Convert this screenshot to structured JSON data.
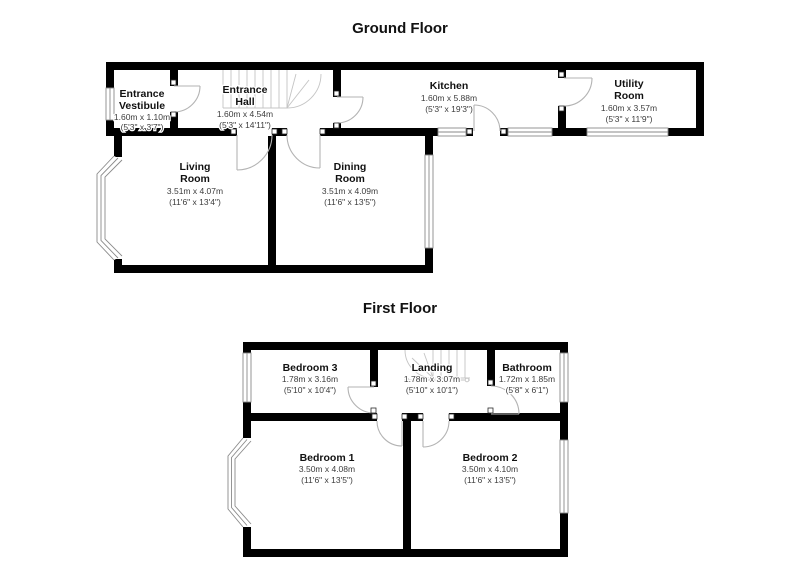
{
  "ground_floor": {
    "title": "Ground Floor",
    "rooms": {
      "entrance_vestibule": {
        "line1": "Entrance",
        "line2": "Vestibule",
        "metric": "1.60m x 1.10m",
        "imperial": "(5'3\" x 3'7\")"
      },
      "entrance_hall": {
        "line1": "Entrance",
        "line2": "Hall",
        "metric": "1.60m x 4.54m",
        "imperial": "(5'3\" x 14'11\")"
      },
      "kitchen": {
        "line1": "Kitchen",
        "metric": "1.60m x 5.88m",
        "imperial": "(5'3\" x 19'3\")"
      },
      "utility_room": {
        "line1": "Utility",
        "line2": "Room",
        "metric": "1.60m x 3.57m",
        "imperial": "(5'3\" x 11'9\")"
      },
      "living_room": {
        "line1": "Living",
        "line2": "Room",
        "metric": "3.51m x 4.07m",
        "imperial": "(11'6\" x 13'4\")"
      },
      "dining_room": {
        "line1": "Dining",
        "line2": "Room",
        "metric": "3.51m x 4.09m",
        "imperial": "(11'6\" x 13'5\")"
      }
    }
  },
  "first_floor": {
    "title": "First Floor",
    "rooms": {
      "bedroom_3": {
        "line1": "Bedroom 3",
        "metric": "1.78m x 3.16m",
        "imperial": "(5'10\" x 10'4\")"
      },
      "landing": {
        "line1": "Landing",
        "metric": "1.78m x 3.07m",
        "imperial": "(5'10\" x 10'1\")"
      },
      "bathroom": {
        "line1": "Bathroom",
        "metric": "1.72m x 1.85m",
        "imperial": "(5'8\" x 6'1\")"
      },
      "bedroom_1": {
        "line1": "Bedroom 1",
        "metric": "3.50m x 4.08m",
        "imperial": "(11'6\" x 13'5\")"
      },
      "bedroom_2": {
        "line1": "Bedroom 2",
        "metric": "3.50m x 4.10m",
        "imperial": "(11'6\" x 13'5\")"
      }
    }
  },
  "colors": {
    "wall": "#000000",
    "door": "#b3b3b3",
    "window": "#8a8a8a",
    "stairs": "#c4c4c4",
    "room_name": "#111111",
    "dimension": "#3c3c3c",
    "background": "#ffffff"
  }
}
